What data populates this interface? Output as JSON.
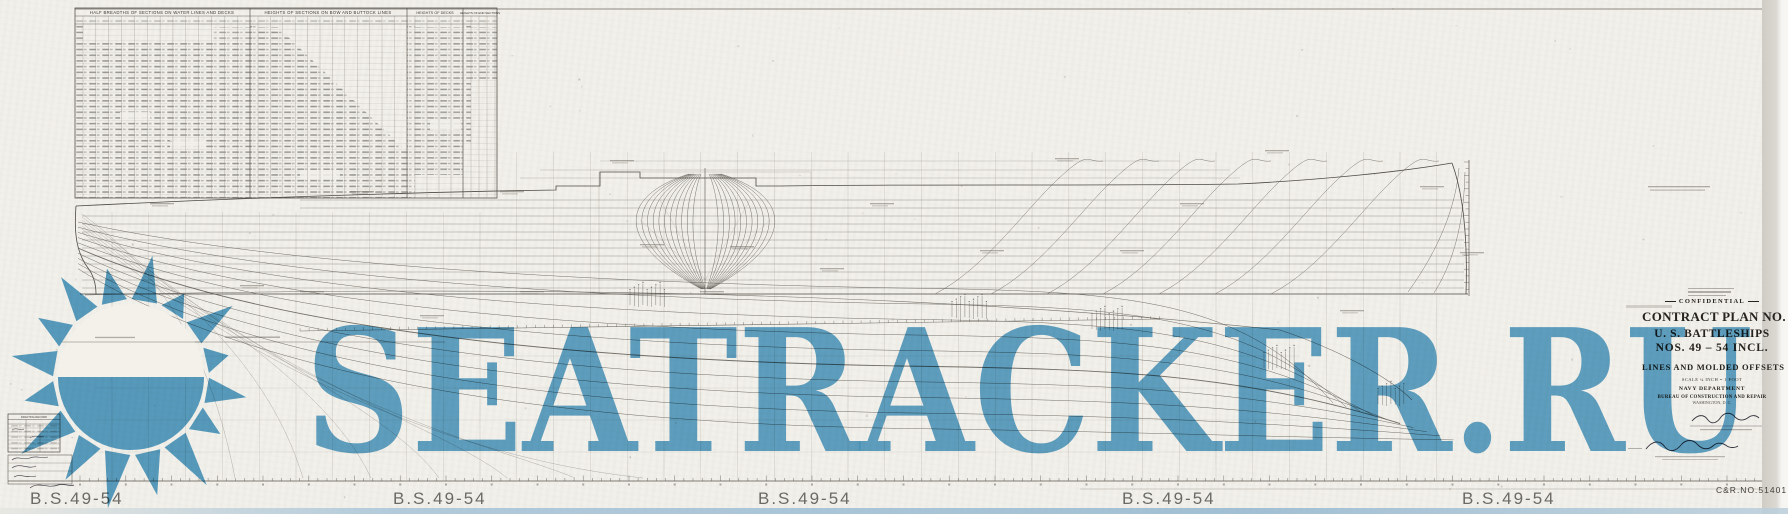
{
  "watermark": {
    "text": "SEATRACKER.RU",
    "color": "#4d9bc7"
  },
  "offset_tables": {
    "half_breadths_title": "HALF BREADTHS OF SECTIONS ON WATER LINES AND DECKS",
    "bow_buttock_title": "HEIGHTS OF SECTIONS ON BOW AND BUTTOCK LINES",
    "decks_title": "HEIGHTS OF DECKS",
    "end_sections_title": "HEIGHTS OF END SECTIONS"
  },
  "title_block": {
    "confidential": "CONFIDENTIAL",
    "plan_no": "CONTRACT PLAN NO. 1",
    "ships": "U. S. BATTLESHIPS",
    "hull_nos": "NOS. 49 – 54 INCL.",
    "subtitle": "LINES AND MOLDED OFFSETS",
    "scale": "SCALE ¼ INCH = 1 FOOT",
    "department": "NAVY DEPARTMENT",
    "bureau": "BUREAU OF CONSTRUCTION AND REPAIR",
    "place_date": "WASHINGTON, D. C."
  },
  "stamps": {
    "drafting_record": "DRAFTING RECORD"
  },
  "sheet": {
    "labels_bottom": [
      "B.S.49-54",
      "B.S.49-54",
      "B.S.49-54",
      "B.S.49-54",
      "B.S.49-54"
    ],
    "drawing_number": "C&R.NO.51401"
  }
}
